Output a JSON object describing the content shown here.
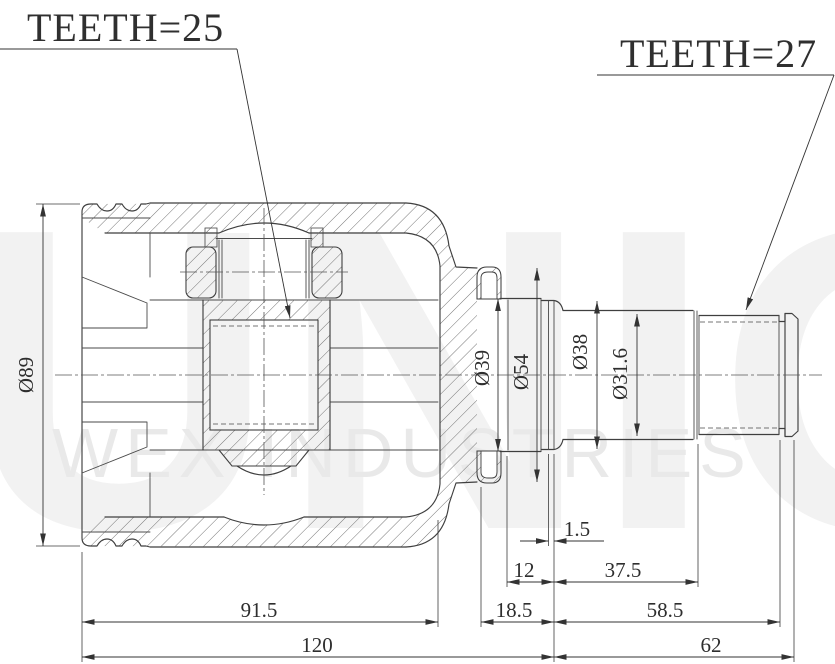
{
  "drawing": {
    "title": "inner-cv-joint-section-drawing",
    "labels": {
      "teeth_left": "TEETH=25",
      "teeth_right": "TEETH=27"
    },
    "watermark": {
      "big": "UNIO",
      "sub": "WEX INDUSTRIES"
    },
    "diameters": {
      "d89": "Ø89",
      "d39": "Ø39",
      "d54": "Ø54",
      "d38": "Ø38",
      "d31_6": "Ø31.6"
    },
    "lengths": {
      "l1_5": "1.5",
      "l12": "12",
      "l37_5": "37.5",
      "l18_5": "18.5",
      "l58_5": "58.5",
      "l91_5": "91.5",
      "l120": "120",
      "l62": "62"
    }
  }
}
